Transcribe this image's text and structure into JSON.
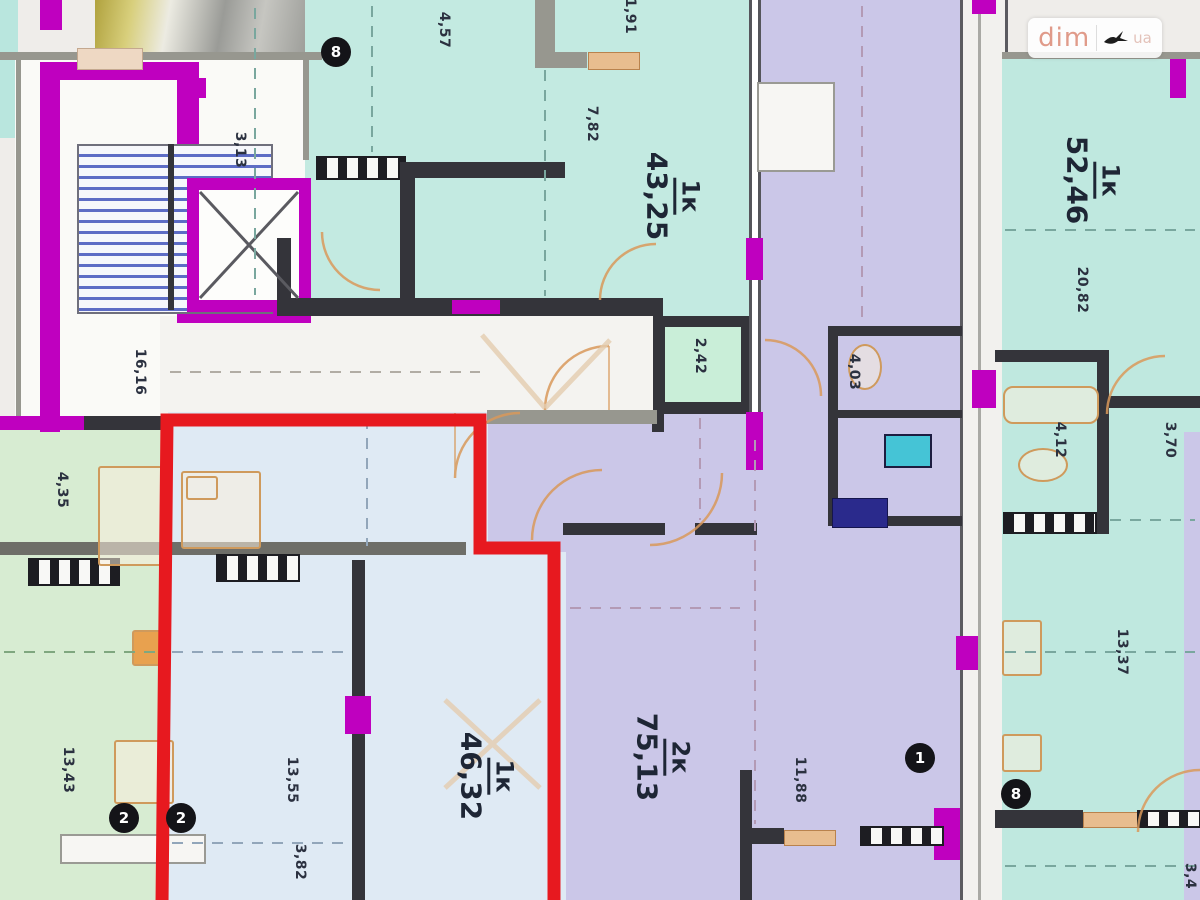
{
  "watermark": {
    "brand": "dim",
    "tld": "ua"
  },
  "apartments": [
    {
      "id": "apt-1k-43-25",
      "unit": "1к",
      "area": "43,25",
      "highlighted": false
    },
    {
      "id": "apt-1k-52-46",
      "unit": "1к",
      "area": "52,46",
      "highlighted": false
    },
    {
      "id": "apt-2k-75-13",
      "unit": "2к",
      "area": "75,13",
      "highlighted": false
    },
    {
      "id": "apt-1k-46-32",
      "unit": "1к",
      "area": "46,32",
      "highlighted": true
    }
  ],
  "dimension_labels": [
    {
      "text": "3,13"
    },
    {
      "text": "16,16"
    },
    {
      "text": "4,57"
    },
    {
      "text": "1,91"
    },
    {
      "text": "7,82"
    },
    {
      "text": "2,42"
    },
    {
      "text": "4,35"
    },
    {
      "text": "13,43"
    },
    {
      "text": "4,03"
    },
    {
      "text": "20,82"
    },
    {
      "text": "4,12"
    },
    {
      "text": "3,70"
    },
    {
      "text": "13,37"
    },
    {
      "text": "13,55"
    },
    {
      "text": "3,82"
    },
    {
      "text": "11,88"
    },
    {
      "text": "3,4"
    }
  ],
  "markers": [
    {
      "label": "8"
    },
    {
      "label": "2"
    },
    {
      "label": "2"
    },
    {
      "label": "1"
    },
    {
      "label": "8"
    }
  ],
  "colors": {
    "highlight_outline": "#e7191f",
    "wall_accent_magenta": "#bf00bf",
    "teal_room": "#c3eae1",
    "mint_room": "#c9eed8",
    "lavender_room": "#cbc7e8",
    "blue_room": "#dfeaf4",
    "green_room": "#d7ecd2",
    "door_orange": "#d9995b"
  }
}
